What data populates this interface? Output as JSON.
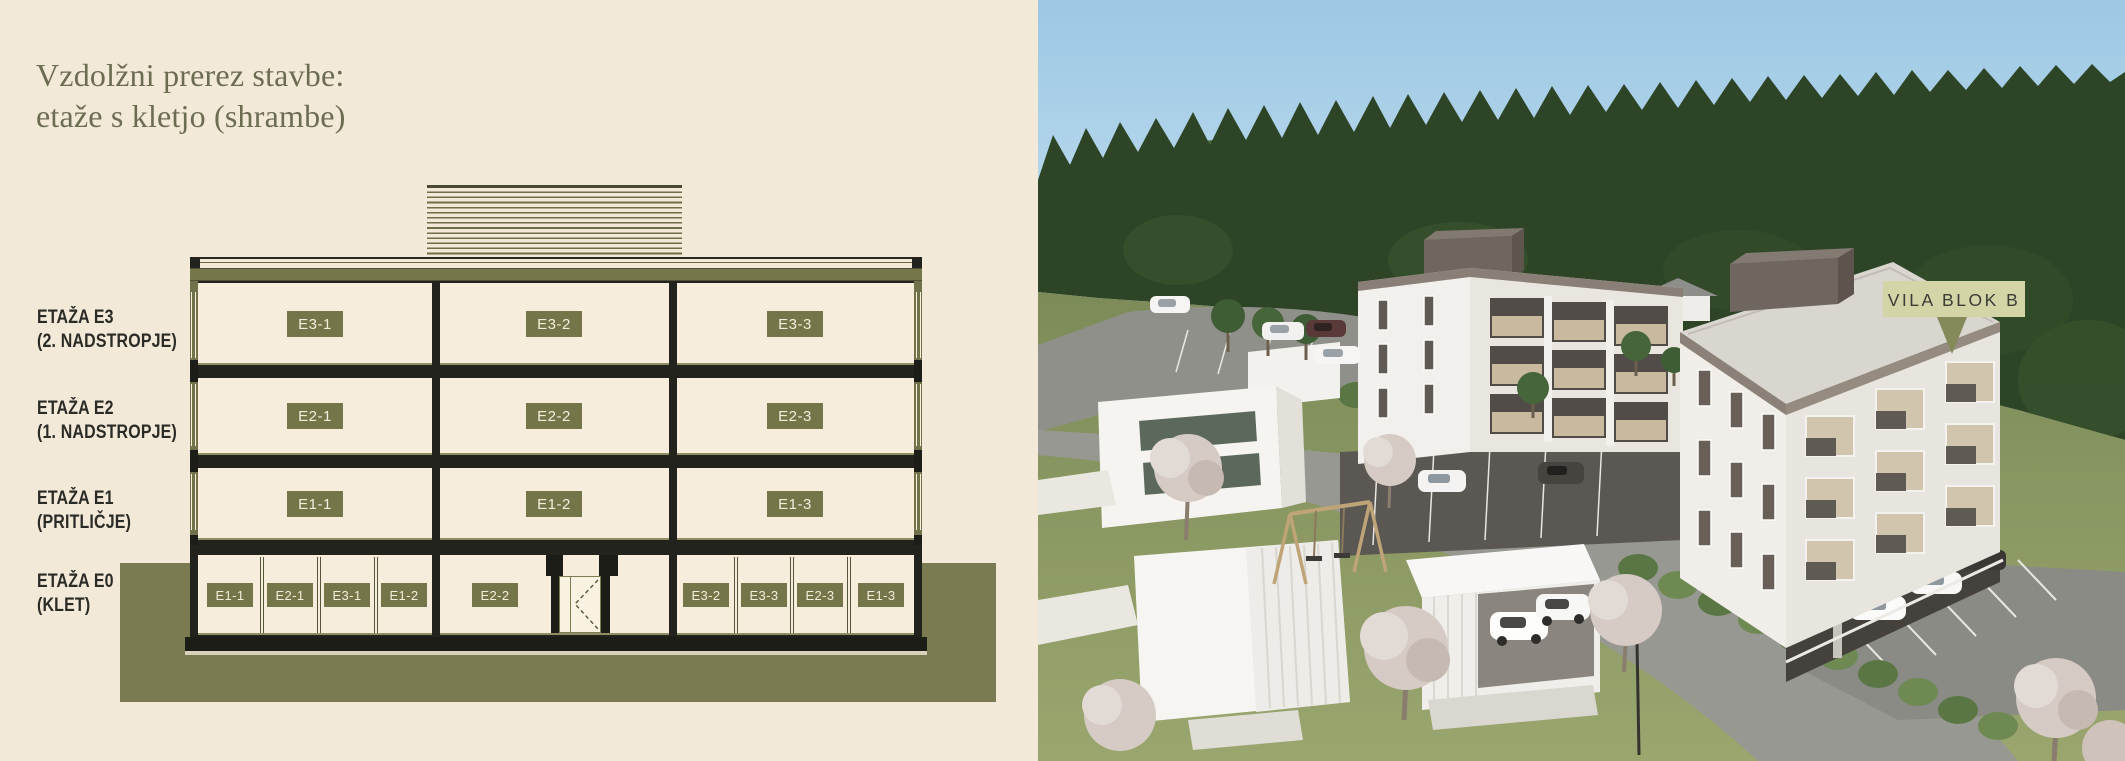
{
  "left_panel": {
    "title_line1": "Vzdolžni prerez stavbe:",
    "title_line2": "etaže s kletjo (shrambe)",
    "floor_labels": [
      {
        "name": "ETAŽA E3",
        "sub": "(2. NADSTROPJE)"
      },
      {
        "name": "ETAŽA E2",
        "sub": "(1. NADSTROPJE)"
      },
      {
        "name": "ETAŽA E1",
        "sub": "(PRITLIČJE)"
      },
      {
        "name": "ETAŽA E0",
        "sub": "(KLET)"
      }
    ],
    "section": {
      "e3_units": [
        "E3-1",
        "E3-2",
        "E3-3"
      ],
      "e2_units": [
        "E2-1",
        "E2-2",
        "E2-3"
      ],
      "e1_units": [
        "E1-1",
        "E1-2",
        "E1-3"
      ],
      "e0_storage": [
        "E1-1",
        "E2-1",
        "E3-1",
        "E1-2",
        "E2-2",
        "E3-2",
        "E3-3",
        "E2-3",
        "E1-3"
      ]
    }
  },
  "render_panel": {
    "building_label": "VILA BLOK B"
  },
  "colors": {
    "cream_bg": "#f3e9d8",
    "olive_badge": "#75754a",
    "olive_ground": "#7b7b51",
    "structure_dark": "#23231d",
    "title_text": "#6c6c52",
    "label_text": "#2b2b26",
    "badge_text": "#f3edda",
    "sky": "#a8d1e8",
    "forest": "#2d4426",
    "grass": "#85935f",
    "road": "#989893",
    "building_white": "#f1eee9",
    "roof_gray": "#d9d5cf",
    "tag_bg": "#d3d5a6",
    "tag_text": "#3b3b37"
  }
}
